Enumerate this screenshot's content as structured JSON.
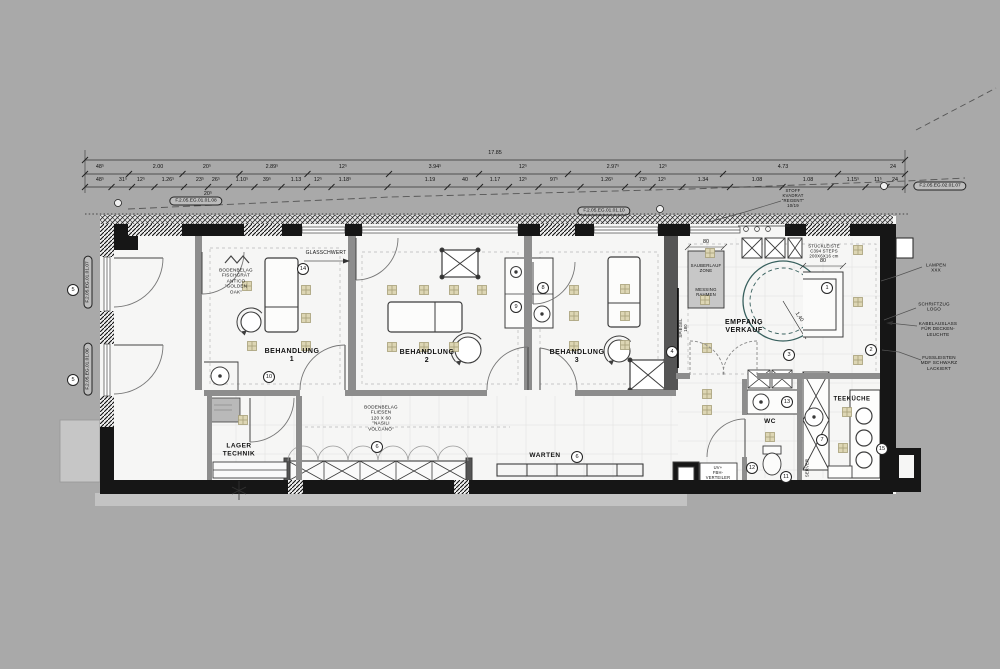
{
  "dimensions": {
    "total": "17.85",
    "row1": [
      "48⁵",
      "2.00",
      "20⁵",
      "2.89⁵",
      "12⁵",
      "3.94⁵",
      "12⁵",
      "2.97⁵",
      "12⁵",
      "4.73",
      "24"
    ],
    "row2": [
      "48⁵",
      "31⁵",
      "12⁵",
      "1.26⁵",
      "23⁵",
      "26⁵",
      "1.10⁵",
      "39⁵",
      "1.13",
      "12⁵",
      "1.18⁵",
      "1.19",
      "40",
      "1.17",
      "12⁵",
      "97⁵",
      "1.26⁵",
      "73⁵",
      "12⁵",
      "1.34",
      "1.08",
      "1.08",
      "1.15⁵",
      "11⁵",
      "24"
    ],
    "row2_sub": "20⁵",
    "dim_80_sauberlauf": "80",
    "dim_80_counter": "80",
    "radius_label": "1,40"
  },
  "reference_tags": {
    "top_left": "F.2.05.EG.01.01.08",
    "top_center": "F.2.05.EG.01.01.10",
    "top_right": "F.2.05.EG.02.01.07",
    "left_upper": "F.2.05.EG.01.01.07",
    "left_lower": "F.2.05.EG.01.01.06"
  },
  "rooms": {
    "behandlung1": "BEHANDLUNG\n1",
    "behandlung2": "BEHANDLUNG\n2",
    "behandlung3": "BEHANDLUNG\n3",
    "empfang": "EMPFANG\nVERKAUF",
    "lager": "LAGER\nTECHNIK",
    "warten": "WARTEN",
    "wc": "WC",
    "teekueche": "TEEKÜCHE"
  },
  "annotations": {
    "glasschwert": "GLASSCHWERT",
    "bodenbelag_behandlung": "BODENBELAG\nFISCHGRÄT\nANTICO\n\"GOLDEN\nOAK\"",
    "bodenbelag_flur": "BODENBELAG\nFLIESEN\n120 X 60\n\"NASILI\nVOLCANO\"",
    "stuckleiste": "STUCKLEISTE\nC394 STEPS\n200X6X16 cm",
    "sauberlauf_zone": "SAUBERLAUF\nZONE",
    "messing_rahmen": "MESSING\nRAHMEN",
    "stoff": "STOFF\nKVADRAT\n\"REGENT\"\n10/19",
    "lampen": "LAMPEN\nXXX",
    "schriftzug": "SCHRIFTZUG\nLOGO",
    "kabelauslass": "KABELAUSLASS\nFÜR DECKEN-\nLEUCHTE",
    "fussleisten": "FUSSLEISTEN\nMDF SCHWARZ\nLACKIERT",
    "spiegel": "SPIEGEL\n180",
    "server": "SERVER",
    "uv_verteiler": "UV+\nFBH-\nVERTEILER"
  },
  "markers": {
    "m1": "1",
    "m2": "2",
    "m3": "3",
    "m4": "4",
    "m5a": "5",
    "m5b": "5",
    "m6a": "6",
    "m6b": "6",
    "m7": "7",
    "m8": "8",
    "m9": "9",
    "m10": "10",
    "m11": "11",
    "m12": "12",
    "m13": "13",
    "m14": "14",
    "m15": "15"
  },
  "colors": {
    "background": "#a9a9a9",
    "wall": "#161616",
    "partition": "#8d8d8d",
    "dark_partition": "#555555",
    "desk_circle": "#38605e",
    "light_symbol_fill": "#ddd6b4",
    "light_symbol_stroke": "#a79f78"
  }
}
